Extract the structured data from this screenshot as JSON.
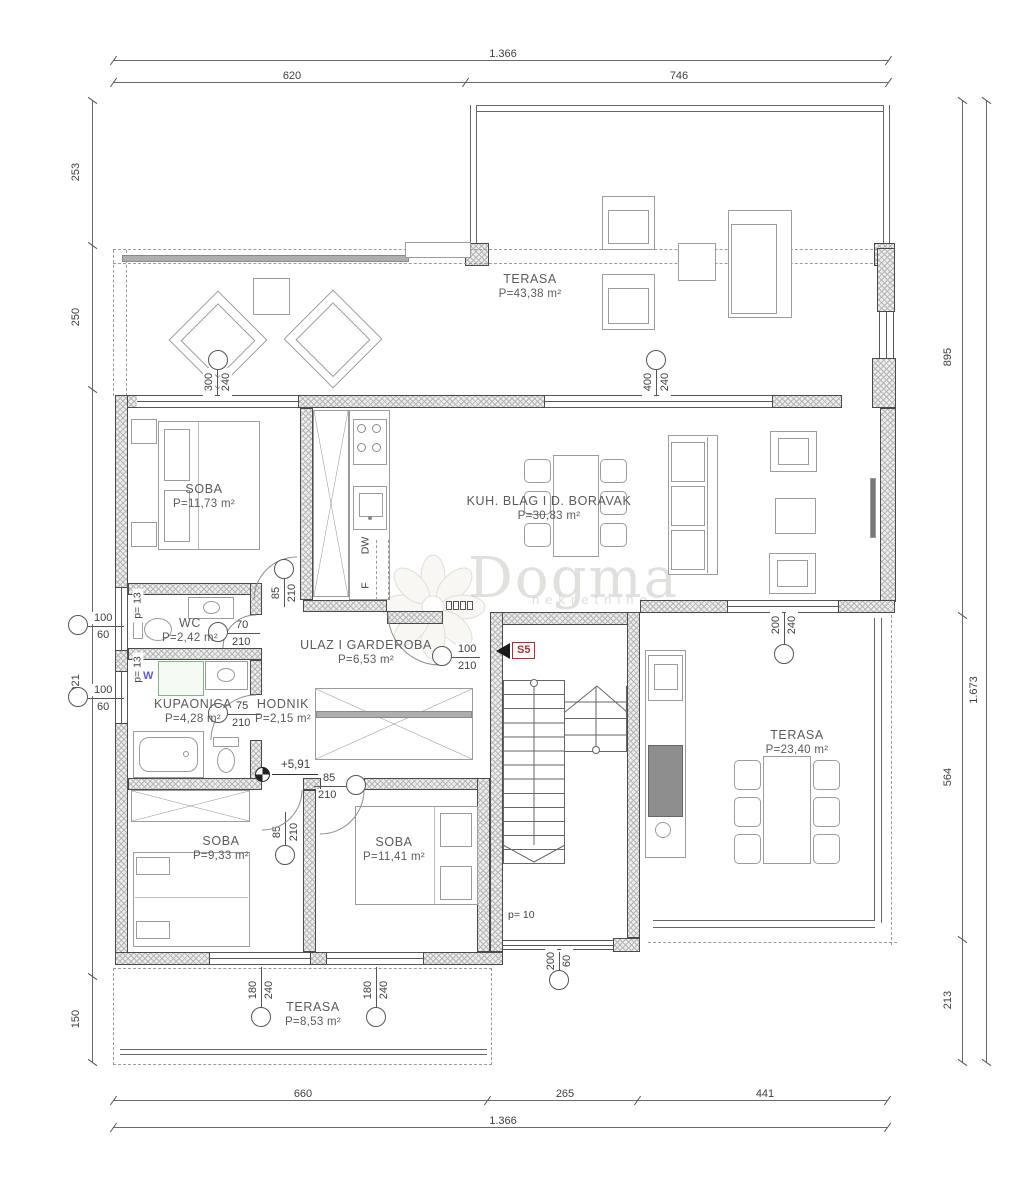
{
  "watermark": {
    "brand": "Dogma",
    "tagline": "nekretnine"
  },
  "rooms": {
    "tt": {
      "name": "TERASA",
      "area": "P=43,38 m²"
    },
    "s1": {
      "name": "SOBA",
      "area": "P=11,73 m²"
    },
    "kuh": {
      "name": "KUH. BLAG I D. BORAVAK",
      "area": "P=30,83 m²"
    },
    "wc": {
      "name": "WC",
      "area": "P=2,42 m²"
    },
    "ulaz": {
      "name": "ULAZ I GARDEROBA",
      "area": "P=6,53 m²"
    },
    "kup": {
      "name": "KUPAONICA",
      "area": "P=4,28 m²"
    },
    "hod": {
      "name": "HODNIK",
      "area": "P=2,15 m²"
    },
    "s2": {
      "name": "SOBA",
      "area": "P=9,33 m²"
    },
    "s3": {
      "name": "SOBA",
      "area": "P=11,41 m²"
    },
    "tr": {
      "name": "TERASA",
      "area": "P=23,40 m²"
    },
    "tb": {
      "name": "TERASA",
      "area": "P=8,53 m²"
    }
  },
  "dims": {
    "t_total": "1.366",
    "t_a": "620",
    "t_b": "746",
    "b_a": "660",
    "b_b": "265",
    "b_c": "441",
    "b_total": "1.366",
    "l_a": "253",
    "l_b": "250",
    "l_c": "1.021",
    "l_d": "150",
    "r_a": "895",
    "r_b": "564",
    "r_c": "213",
    "r_total": "1.673"
  },
  "openings": {
    "o300": {
      "a": "300",
      "b": "240"
    },
    "o400": {
      "a": "400",
      "b": "240"
    },
    "o85k": {
      "a": "85",
      "b": "210"
    },
    "o85h": {
      "a": "85",
      "b": "210"
    },
    "o85s": {
      "a": "85",
      "b": "210"
    },
    "o70": {
      "a": "70",
      "b": "210"
    },
    "o75": {
      "a": "75",
      "b": "210"
    },
    "o100d": {
      "a": "100",
      "b": "210"
    },
    "o100w1": {
      "a": "100",
      "b": "60"
    },
    "o100w2": {
      "a": "100",
      "b": "60"
    },
    "o180a": {
      "a": "180",
      "b": "240"
    },
    "o180b": {
      "a": "180",
      "b": "240"
    },
    "o200s": {
      "a": "200",
      "b": "60"
    },
    "o200t": {
      "a": "200",
      "b": "240"
    }
  },
  "ann": {
    "s5": "S5",
    "level": "+5,91",
    "p10": "p= 10",
    "p13a": "p= 13",
    "p13b": "p= 13",
    "w": "W",
    "dw": "DW",
    "f": "F"
  }
}
